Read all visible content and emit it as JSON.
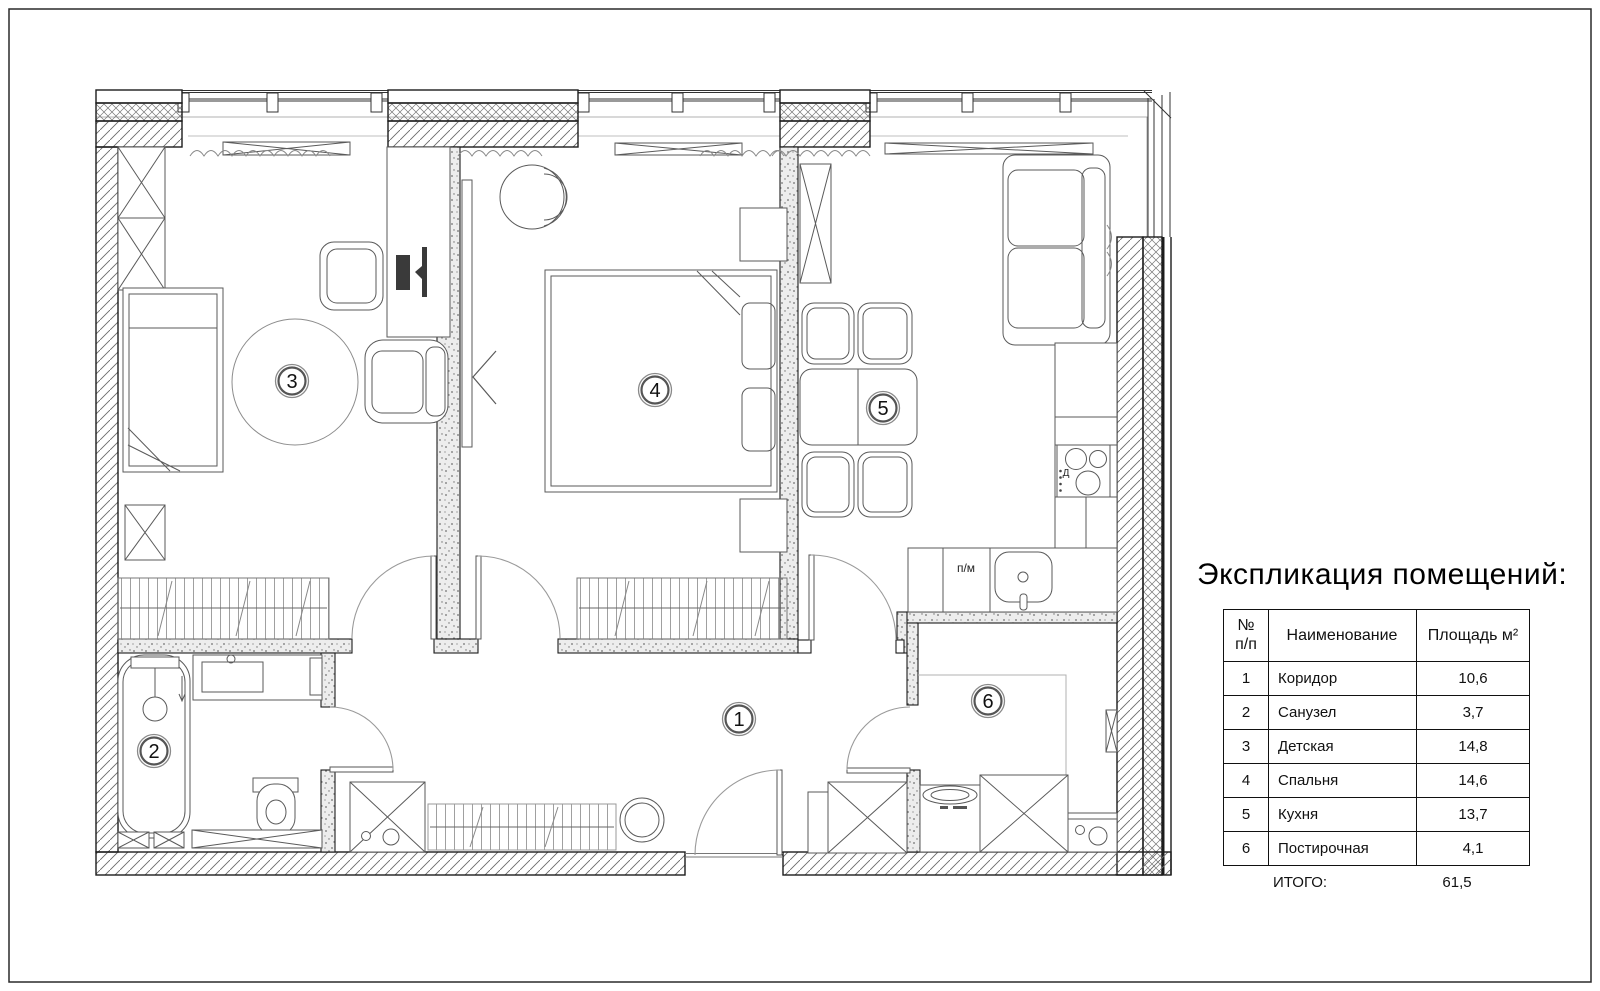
{
  "colors": {
    "paper": "#ffffff",
    "ink": "#111111",
    "hatch_gray": "#6a6a6a",
    "partition_gray": "#ececec"
  },
  "legend": {
    "title": "Экспликация помещений:",
    "headers": {
      "num": "№\nп/п",
      "name": "Наименование",
      "area": "Площадь м²"
    },
    "rows": [
      {
        "num": "1",
        "name": "Коридор",
        "area": "10,6"
      },
      {
        "num": "2",
        "name": "Санузел",
        "area": "3,7"
      },
      {
        "num": "3",
        "name": "Детская",
        "area": "14,8"
      },
      {
        "num": "4",
        "name": "Спальня",
        "area": "14,6"
      },
      {
        "num": "5",
        "name": "Кухня",
        "area": "13,7"
      },
      {
        "num": "6",
        "name": "Постирочная",
        "area": "4,1"
      }
    ],
    "total": {
      "label": "ИТОГО:",
      "value": "61,5"
    }
  },
  "plan": {
    "labels": {
      "dishwasher": "п/м",
      "stove_gas": "Д"
    }
  }
}
